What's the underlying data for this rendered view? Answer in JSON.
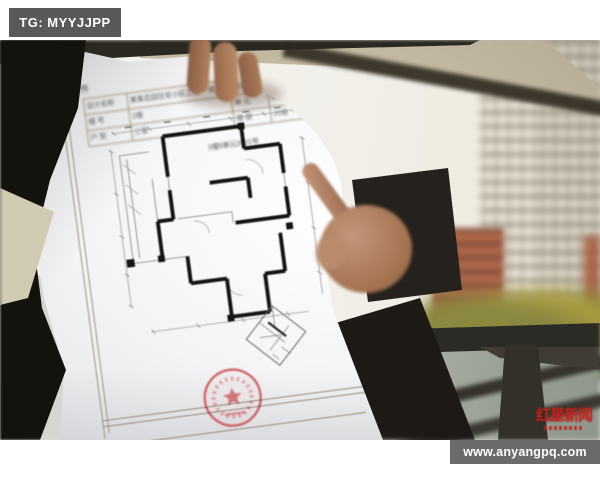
{
  "watermark_top": {
    "label": "TG: MYYJJPP"
  },
  "watermark_bottom": {
    "label": "www.anyangpq.com"
  },
  "press_logo": {
    "title": "红星新闻"
  },
  "paper_doc": {
    "title": "附件",
    "table": {
      "rows": [
        {
          "c0": "设计名称",
          "c1": "某某花园住宅小区工程 一期",
          "c2": "测绘单位",
          "c3": "某某测绘有限公司"
        },
        {
          "c0": "幢 号",
          "c1": "1幢",
          "c2": "单 元",
          "c3": "5单元"
        },
        {
          "c0": "户 型",
          "c1": "三室",
          "c2": "楼 层",
          "c3": "20层"
        }
      ]
    },
    "caption": "1幢5单元2021号"
  },
  "colors": {
    "badge_bg": "#5a5a5c",
    "badge_text": "#ffffff",
    "logo_red": "#c0251d",
    "stamp_red": "#c64b4b",
    "wall_ink": "#141414",
    "orange_building": "#ad674b"
  }
}
